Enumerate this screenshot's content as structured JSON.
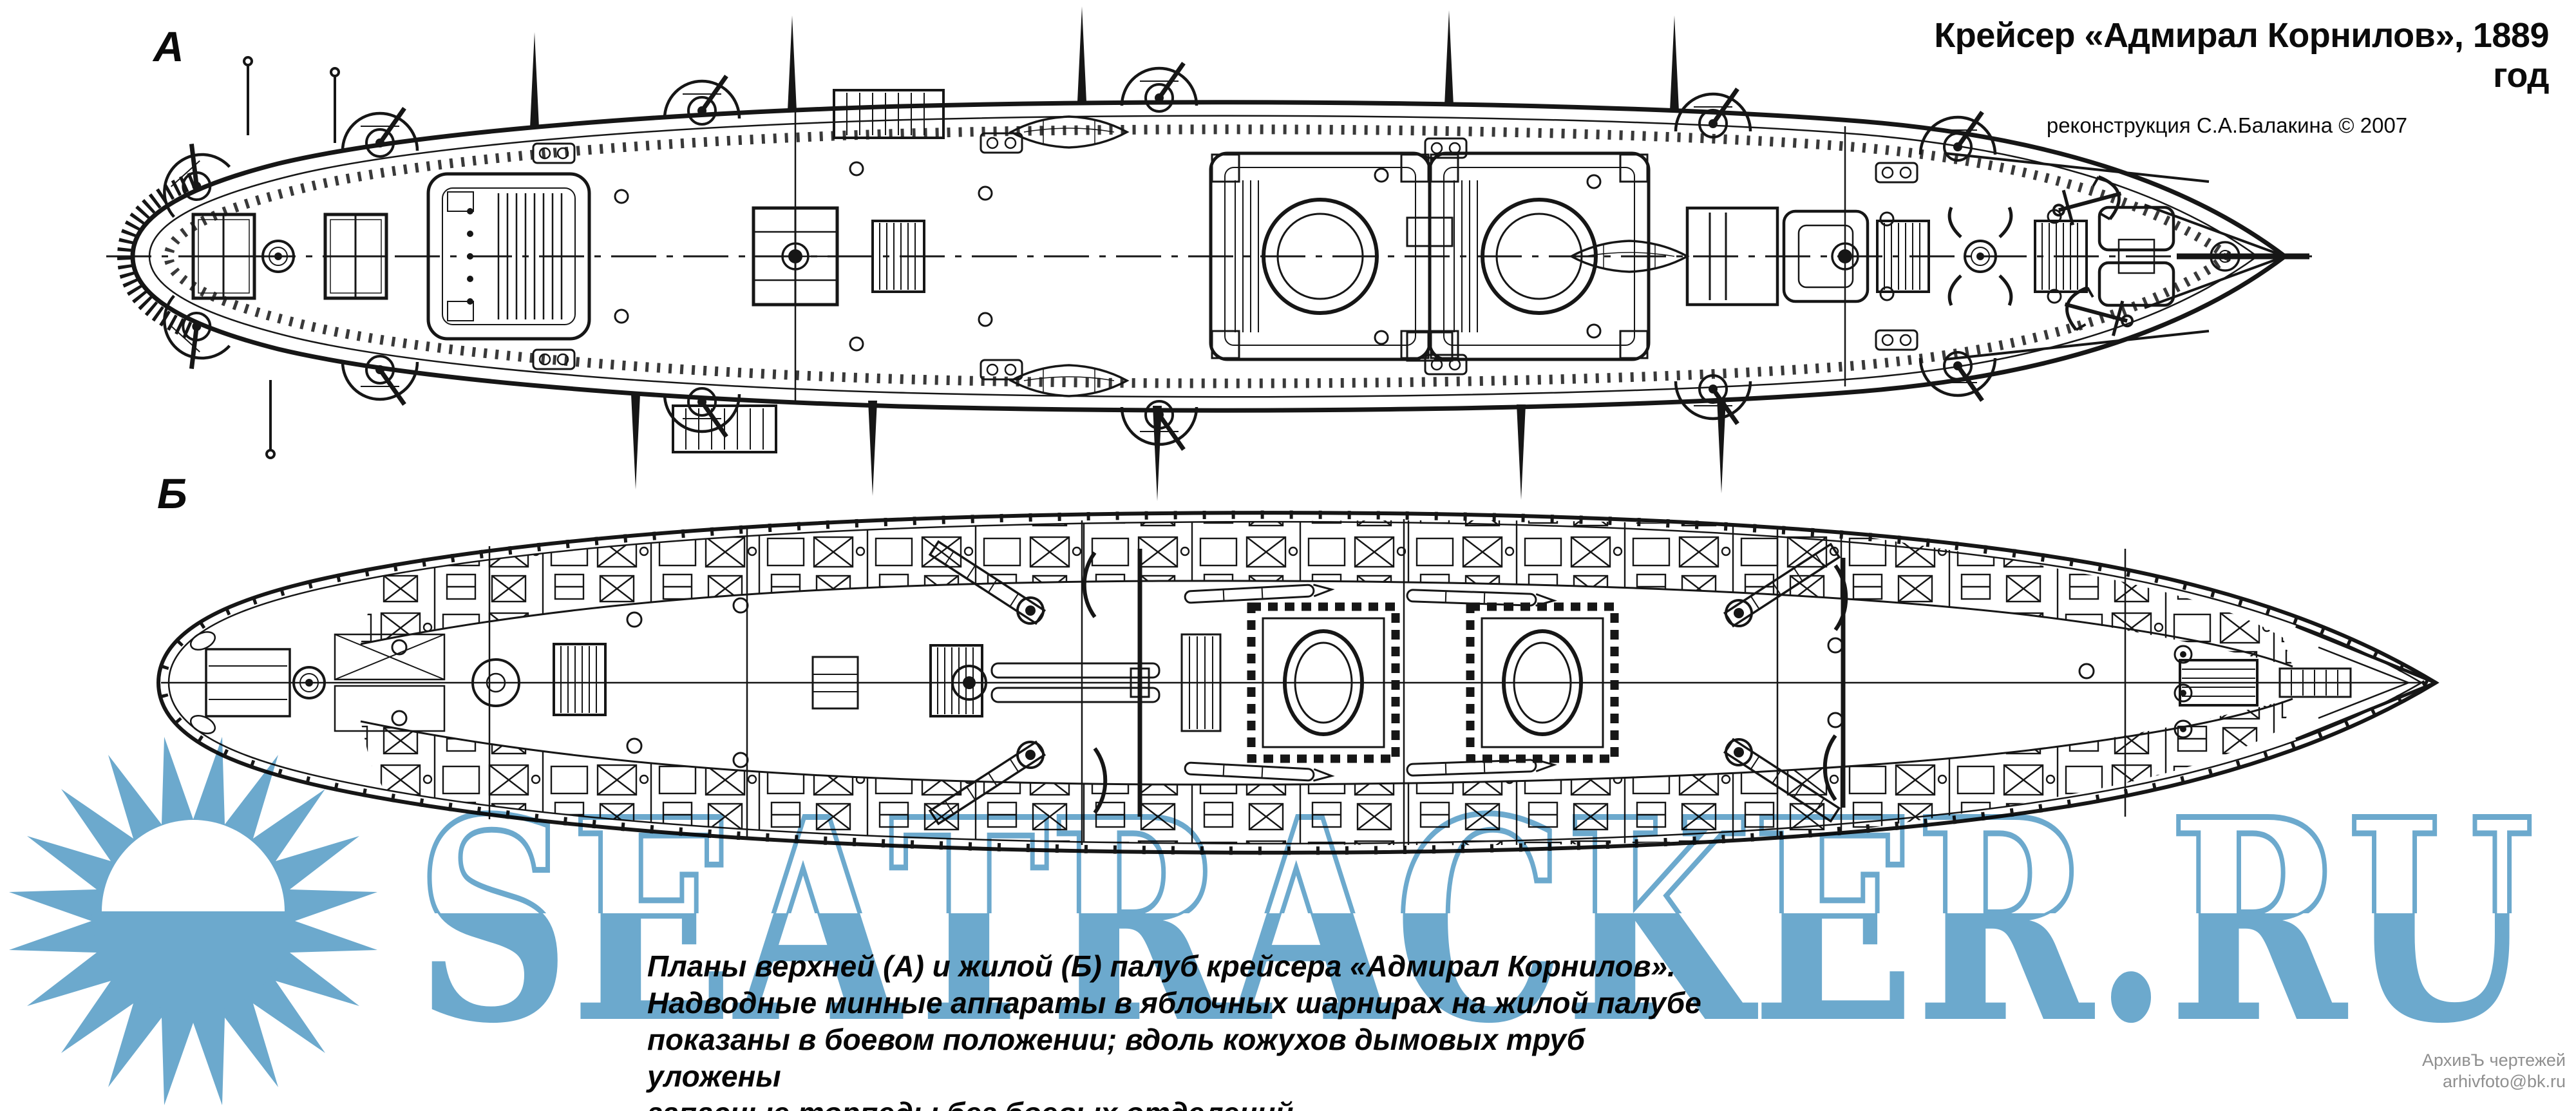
{
  "header": {
    "title": "Крейсер «Адмирал Корнилов», 1889 год",
    "subtitle": "реконструкция С.А.Балакина © 2007"
  },
  "plan_labels": {
    "upper": "А",
    "lower": "Б"
  },
  "caption": {
    "lines": [
      "Планы верхней (А) и жилой (Б) палуб крейсера «Адмирал Корнилов».",
      "Надводные минные аппараты в яблочных шарнирах на жилой палубе",
      "показаны в боевом положении; вдоль кожухов дымовых труб уложены",
      "запасные торпеды без боевых отделений."
    ]
  },
  "watermark": {
    "text": "SEATRACKER.RU",
    "color": "#6ca9cd"
  },
  "credit": {
    "archive": "АрхивЪ чертежей",
    "email": "arhivfoto@bk.ru"
  },
  "colors": {
    "ink": "#161616",
    "paper": "#ffffff",
    "credit_gray": "#8f8f8f"
  }
}
